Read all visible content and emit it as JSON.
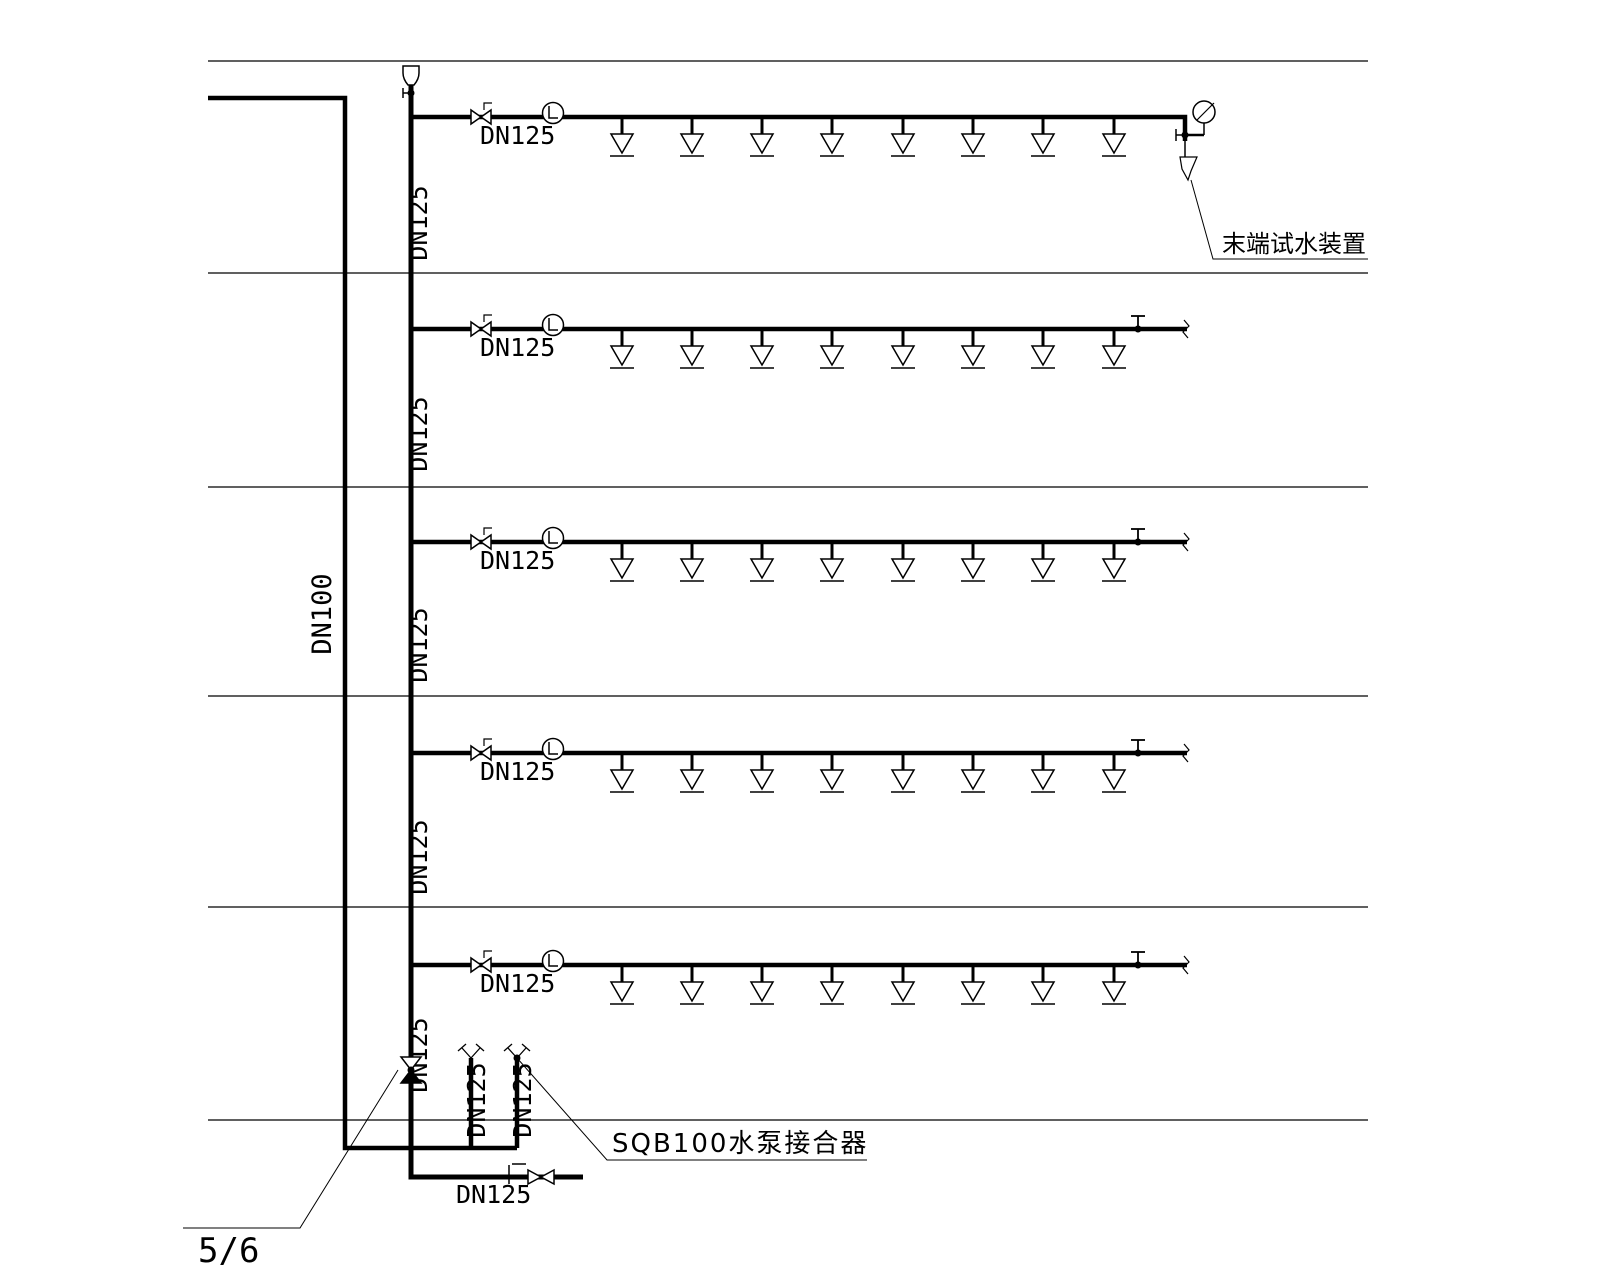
{
  "colors": {
    "line": "#000000",
    "background": "#ffffff"
  },
  "diagram": {
    "width": 1600,
    "height": 1280,
    "floor_lines": {
      "x1": 208,
      "x2": 1368,
      "ys": [
        61,
        273,
        487,
        696,
        907,
        1120
      ]
    },
    "dn100_feed": {
      "path": [
        [
          208,
          98
        ],
        [
          345,
          98
        ],
        [
          345,
          1148
        ],
        [
          517,
          1148
        ]
      ],
      "label": {
        "text": "DN100",
        "x": 331,
        "y": 614
      }
    },
    "riser": {
      "x": 411,
      "top": 85,
      "bottom": 1177,
      "air_vent_y": 75,
      "vent_valve_y": 93,
      "check_valve_y": 1070,
      "labels": [
        {
          "text": "DN125",
          "x": 427,
          "y": 223
        },
        {
          "text": "DN125",
          "x": 427,
          "y": 434
        },
        {
          "text": "DN125",
          "x": 427,
          "y": 645
        },
        {
          "text": "DN125",
          "x": 427,
          "y": 857
        },
        {
          "text": "DN125",
          "x": 427,
          "y": 1055
        }
      ]
    },
    "branch_style": {
      "start_x": 411,
      "end_x": 1187,
      "elbow_x": 1185,
      "valve_x": 481,
      "flow_indicator_x": 553,
      "label": "DN125",
      "label_x": 480,
      "label_dy": 27,
      "sprinkler_xs": [
        622,
        692,
        762,
        832,
        903,
        973,
        1043,
        1114
      ],
      "test_valve_x": 1138
    },
    "branches": [
      {
        "y": 117,
        "end": "test_device",
        "label": "DN125"
      },
      {
        "y": 329,
        "end": "break",
        "label": "DN125"
      },
      {
        "y": 542,
        "end": "break",
        "label": "DN125"
      },
      {
        "y": 753,
        "end": "break",
        "label": "DN125"
      },
      {
        "y": 965,
        "end": "break",
        "label": "DN125"
      }
    ],
    "end_test_assembly": {
      "pipe_x": 1185,
      "valve_y": 135,
      "gauge_x": 1204,
      "gauge_y": 112,
      "funnel_y": 157,
      "label": {
        "text": "末端试水装置",
        "x": 1222,
        "y": 252
      },
      "leader": [
        [
          1191,
          180
        ],
        [
          1213,
          259
        ],
        [
          1368,
          259
        ]
      ]
    },
    "pump_connection": {
      "top": 1058,
      "bottom": 1148,
      "pipes": [
        {
          "x": 471,
          "label": {
            "text": "DN125",
            "x": 485,
            "y": 1100
          }
        },
        {
          "x": 517,
          "label": {
            "text": "DN125",
            "x": 531,
            "y": 1100
          }
        }
      ],
      "label": {
        "text": "SQB100水泵接合器",
        "x": 612,
        "y": 1152
      },
      "leader": [
        [
          517,
          1058
        ],
        [
          607,
          1160
        ],
        [
          867,
          1160
        ]
      ]
    },
    "bottom_run": {
      "y": 1177,
      "x1": 411,
      "x2": 583,
      "gate_x": 509,
      "check_x": 540,
      "label": {
        "text": "DN125",
        "x": 456,
        "y": 1203
      }
    },
    "sheet_ref": {
      "label": {
        "text": "5/6",
        "x": 198,
        "y": 1262
      },
      "leader": [
        [
          398,
          1070
        ],
        [
          300,
          1228
        ],
        [
          183,
          1228
        ]
      ]
    }
  }
}
